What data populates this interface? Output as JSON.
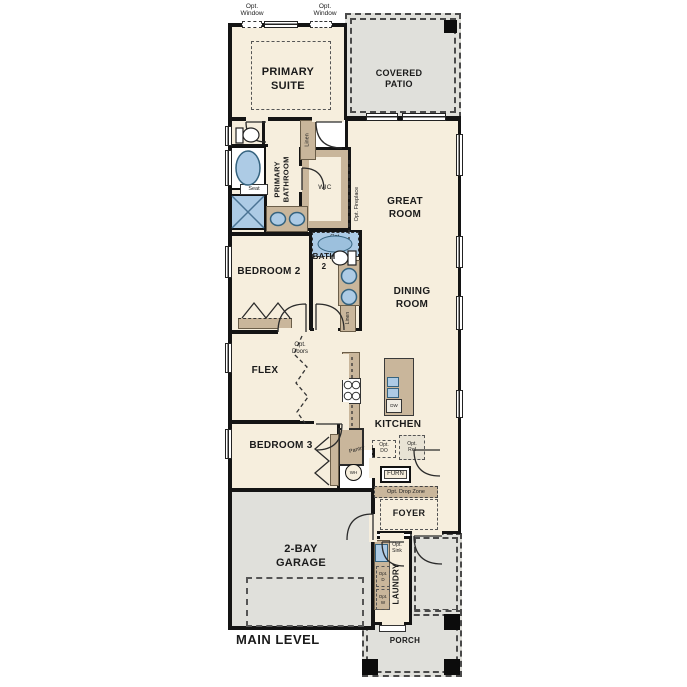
{
  "plan_title": "MAIN LEVEL",
  "rooms": {
    "primary_suite": "PRIMARY\nSUITE",
    "covered_patio": "COVERED\nPATIO",
    "primary_bathroom": "PRIMARY\nBATHROOM",
    "wic": "WIC",
    "great_room": "GREAT\nROOM",
    "bedroom_2": "BEDROOM 2",
    "bath_2": "BATH\n2",
    "dining_room": "DINING\nROOM",
    "flex": "FLEX",
    "kitchen": "KITCHEN",
    "bedroom_3": "BEDROOM 3",
    "foyer": "FOYER",
    "garage": "2-BAY\nGARAGE",
    "laundry": "LAUNDRY",
    "porch": "PORCH"
  },
  "annotations": {
    "opt_window": "Opt.\nWindow",
    "linen": "Linen",
    "seat": "Seat",
    "opt_fireplace": "Opt. Fireplace",
    "opt_shower": "Opt.\nShower",
    "opt_doors": "Opt.\nDoors",
    "pantry": "Pantry",
    "opt_do": "Opt.\nDO",
    "opt_ref": "Opt.\nRef",
    "wh": "WH",
    "furn": "FURN",
    "opt_drop_zone": "Opt. Drop Zone",
    "opt_sink": "Opt.\nSink",
    "opt_d": "Opt.\nD",
    "opt_w": "Opt.\nW",
    "dw": "DW"
  },
  "colors": {
    "floor": "#f6eedd",
    "concrete": "#e0e0db",
    "casework": "#c9b69b",
    "fixture": "#adcbe5",
    "wall": "#141414"
  }
}
